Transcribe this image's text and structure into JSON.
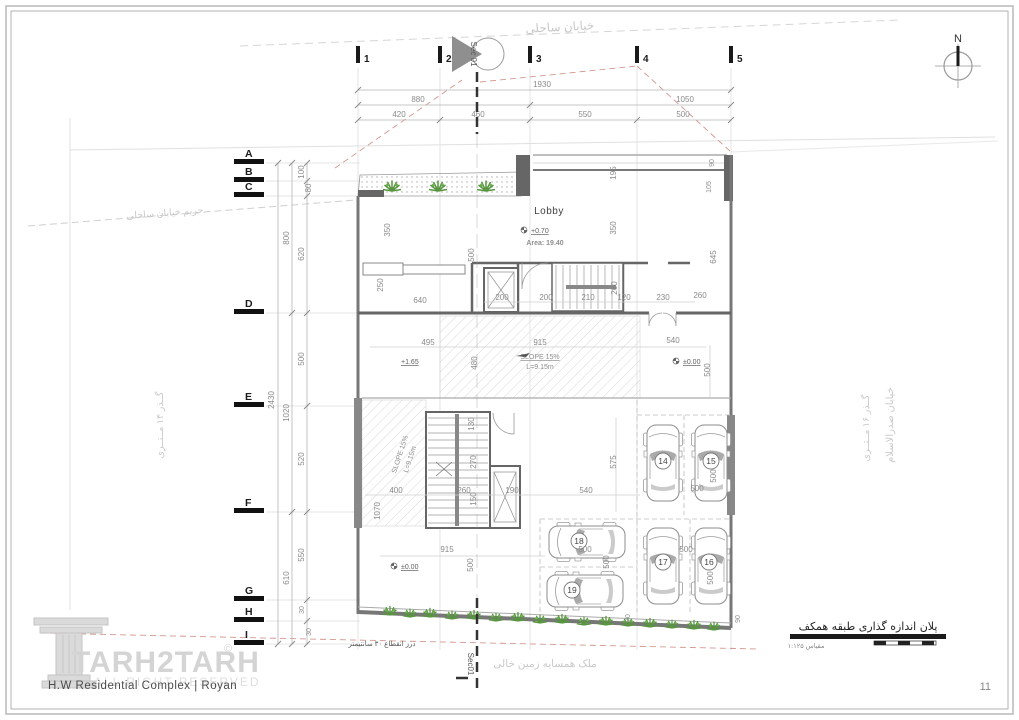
{
  "page": {
    "number": "11"
  },
  "compass": {
    "label": "N"
  },
  "watermark": {
    "brand": "TARH2TARH",
    "symbol": "©",
    "rights": "ALL RIGHT RESERVED"
  },
  "footer": {
    "project": "H.W Residential Complex | Royan"
  },
  "titleblock": {
    "title": "پلان اندازه گذاری طبقه همکف",
    "scale": "مقیاس ۱:۱۲۵"
  },
  "section": {
    "top": "Sec 01",
    "bottom": "Sec01"
  },
  "grid": {
    "cols": [
      "1",
      "2",
      "3",
      "4",
      "5"
    ],
    "rows": [
      "A",
      "B",
      "C",
      "D",
      "E",
      "F",
      "G",
      "H",
      "I"
    ]
  },
  "streets": {
    "top": "خیابان ساحلی",
    "setback": "حریم خیابان ساحلی",
    "left": "گــذر ۱۴ مــتــری",
    "right_main": "خیابان صدرالاسلام",
    "right_passage": "گــذر ۱۶ مــتــری",
    "bottom_neighbor": "ملک همسایه زمین خالی",
    "expansion_joint": "درز انقطاع ۳۰ سانتیمتر"
  },
  "labels": {
    "lobby": "Lobby",
    "lobby_level": "+0.70",
    "lobby_area": "Area: 19.40",
    "level_a": "+1.65",
    "level_b": "±0.00",
    "level_c": "±0.00",
    "slope_a": "SLOPE 15%",
    "slope_a_len": "L=9.15m",
    "slope_b": "SLOPE 15%",
    "slope_b_len": "L=9.15m"
  },
  "parking": {
    "numbers": [
      "14",
      "15",
      "16",
      "17",
      "18",
      "19"
    ]
  },
  "dims": {
    "top": [
      "1930",
      "880",
      "1050",
      "420",
      "460",
      "550",
      "500"
    ],
    "left": [
      "2430",
      "800",
      "1020",
      "610",
      "100",
      "80",
      "620",
      "500",
      "520",
      "550",
      "30",
      "30"
    ],
    "plan": [
      "350",
      "350",
      "250",
      "640",
      "500",
      "200",
      "200",
      "210",
      "120",
      "230",
      "260",
      "260",
      "645",
      "495",
      "915",
      "480",
      "540",
      "500",
      "130",
      "270",
      "260",
      "150",
      "190",
      "540",
      "575",
      "400",
      "1070",
      "500",
      "500",
      "500",
      "500",
      "500",
      "500",
      "915",
      "500",
      "70",
      "90",
      "195",
      "90",
      "105"
    ]
  }
}
